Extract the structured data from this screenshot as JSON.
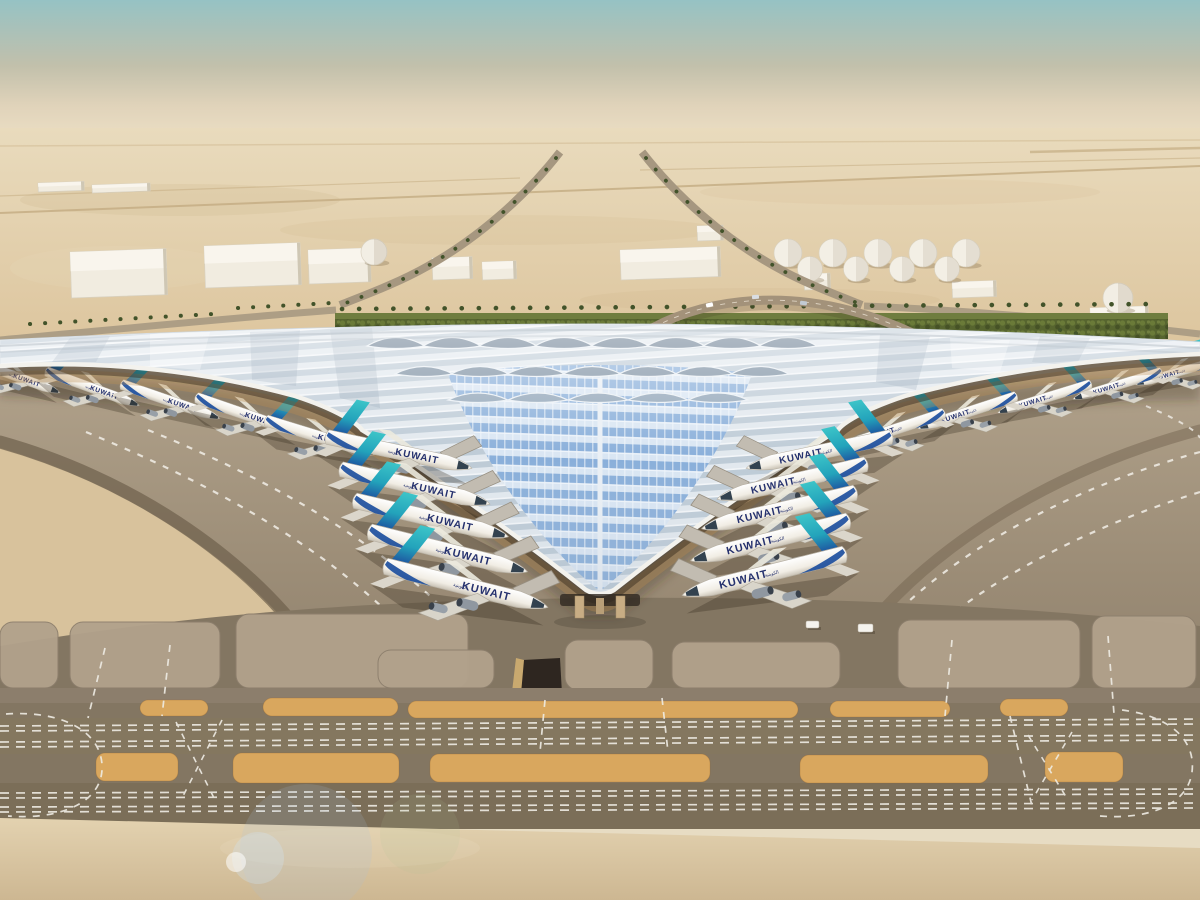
{
  "scene": {
    "name": "kuwait-airport-terminal-aerial-rendering",
    "subject": "Trefoil-roofed airport terminal in desert with aircraft at gates",
    "sky_top": "#9dc6c6",
    "sky_horizon": "#e9dcc2"
  },
  "airline": {
    "title": "KUWAIT",
    "arabic_script": "الكويتية",
    "tail_teal": "#35b9c2",
    "tail_blue": "#1d4f9e",
    "title_color": "#25316e"
  },
  "palette": {
    "desert": "#e2cfa9",
    "apron": "#ab9c85",
    "taxiway": "#84775f",
    "sand_island": "#d9a75e",
    "bottom_sand": "#ddcba7",
    "roof_light": "#e3e9ef",
    "roof_stripe": "#b9c7d3",
    "v_blue": "#84abd8",
    "hedge_green": "#57652f",
    "fascia_white": "#f3f2ed"
  },
  "aircraft": [
    {
      "x": 398,
      "y": 452,
      "r": 12,
      "s": 1.22,
      "flip": 0,
      "bridge": 1
    },
    {
      "x": 414,
      "y": 486,
      "r": 13,
      "s": 1.26,
      "flip": 0,
      "bridge": 1
    },
    {
      "x": 430,
      "y": 518,
      "r": 13,
      "s": 1.3,
      "flip": 0,
      "bridge": 1
    },
    {
      "x": 447,
      "y": 551,
      "r": 14,
      "s": 1.34,
      "flip": 0,
      "bridge": 1
    },
    {
      "x": 465,
      "y": 586,
      "r": 14,
      "s": 1.38,
      "flip": 0,
      "bridge": 1
    },
    {
      "x": 820,
      "y": 452,
      "r": 12,
      "s": 1.22,
      "flip": 1,
      "bridge": 1
    },
    {
      "x": 793,
      "y": 481,
      "r": 13,
      "s": 1.26,
      "flip": 1,
      "bridge": 1
    },
    {
      "x": 780,
      "y": 510,
      "r": 13,
      "s": 1.3,
      "flip": 1,
      "bridge": 1
    },
    {
      "x": 771,
      "y": 540,
      "r": 14,
      "s": 1.34,
      "flip": 1,
      "bridge": 1
    },
    {
      "x": 765,
      "y": 574,
      "r": 14,
      "s": 1.38,
      "flip": 1,
      "bridge": 1
    },
    {
      "x": 15,
      "y": 376,
      "r": 20,
      "s": 0.78,
      "flip": 0,
      "bridge": 0
    },
    {
      "x": 92,
      "y": 388,
      "r": 20,
      "s": 0.82,
      "flip": 0,
      "bridge": 0
    },
    {
      "x": 170,
      "y": 401,
      "r": 19,
      "s": 0.86,
      "flip": 0,
      "bridge": 0
    },
    {
      "x": 247,
      "y": 415,
      "r": 19,
      "s": 0.9,
      "flip": 0,
      "bridge": 0
    },
    {
      "x": 320,
      "y": 437,
      "r": 17,
      "s": 0.95,
      "flip": 0,
      "bridge": 0
    },
    {
      "x": 1178,
      "y": 372,
      "r": 16,
      "s": 0.72,
      "flip": 1,
      "bridge": 0
    },
    {
      "x": 1118,
      "y": 385,
      "r": 17,
      "s": 0.76,
      "flip": 1,
      "bridge": 0
    },
    {
      "x": 1045,
      "y": 398,
      "r": 17,
      "s": 0.8,
      "flip": 1,
      "bridge": 0
    },
    {
      "x": 968,
      "y": 412,
      "r": 18,
      "s": 0.85,
      "flip": 1,
      "bridge": 0
    },
    {
      "x": 893,
      "y": 430,
      "r": 18,
      "s": 0.9,
      "flip": 1,
      "bridge": 0
    }
  ],
  "roof_modules": {
    "rows": [
      {
        "y": 346,
        "rx": 29,
        "ry": 17,
        "fill": "#5e7389",
        "xs": [
          396,
          452,
          508,
          564,
          620,
          676,
          732,
          788
        ]
      },
      {
        "y": 374,
        "rx": 29,
        "ry": 15,
        "fill": "#74889c",
        "xs": [
          424,
          480,
          536,
          592,
          648,
          704,
          760
        ]
      },
      {
        "y": 400,
        "rx": 30,
        "ry": 14,
        "fill": "#8ba0b4",
        "xs": [
          478,
          538,
          598,
          658,
          718
        ]
      }
    ]
  },
  "fuel_tanks": {
    "rows": [
      {
        "y": 253,
        "r": 14,
        "xs": [
          788,
          833,
          878,
          923,
          966
        ]
      },
      {
        "y": 269,
        "r": 12.5,
        "xs": [
          810,
          856,
          902,
          947
        ]
      }
    ]
  },
  "buildings": [
    {
      "x": 70,
      "y": 252,
      "w": 96,
      "h": 46
    },
    {
      "x": 204,
      "y": 246,
      "w": 96,
      "h": 42
    },
    {
      "x": 308,
      "y": 250,
      "w": 62,
      "h": 34
    },
    {
      "x": 432,
      "y": 258,
      "w": 40,
      "h": 22
    },
    {
      "x": 482,
      "y": 262,
      "w": 34,
      "h": 18
    },
    {
      "x": 620,
      "y": 250,
      "w": 100,
      "h": 30
    },
    {
      "x": 697,
      "y": 226,
      "w": 26,
      "h": 15
    },
    {
      "x": 804,
      "y": 274,
      "w": 26,
      "h": 16
    },
    {
      "x": 952,
      "y": 282,
      "w": 44,
      "h": 16
    },
    {
      "x": 1090,
      "y": 308,
      "w": 58,
      "h": 14
    },
    {
      "x": 38,
      "y": 183,
      "w": 46,
      "h": 9
    },
    {
      "x": 92,
      "y": 185,
      "w": 58,
      "h": 8
    }
  ],
  "domes": [
    {
      "cx": 374,
      "cy": 252,
      "r": 13
    },
    {
      "cx": 1118,
      "cy": 298,
      "r": 15
    }
  ],
  "sand_islands": [
    {
      "x": 140,
      "y": 700,
      "w": 68,
      "h": 16
    },
    {
      "x": 263,
      "y": 698,
      "w": 135,
      "h": 18
    },
    {
      "x": 408,
      "y": 701,
      "w": 390,
      "h": 17
    },
    {
      "x": 830,
      "y": 701,
      "w": 120,
      "h": 16
    },
    {
      "x": 1000,
      "y": 699,
      "w": 68,
      "h": 17
    },
    {
      "x": 96,
      "y": 753,
      "w": 82,
      "h": 28
    },
    {
      "x": 233,
      "y": 753,
      "w": 166,
      "h": 30
    },
    {
      "x": 430,
      "y": 754,
      "w": 280,
      "h": 28
    },
    {
      "x": 800,
      "y": 755,
      "w": 188,
      "h": 28
    },
    {
      "x": 1045,
      "y": 752,
      "w": 78,
      "h": 30
    }
  ],
  "stand_slabs": [
    {
      "x": 0,
      "y": 622,
      "w": 58,
      "h": 66
    },
    {
      "x": 70,
      "y": 622,
      "w": 150,
      "h": 66
    },
    {
      "x": 236,
      "y": 614,
      "w": 232,
      "h": 74
    },
    {
      "x": 378,
      "y": 650,
      "w": 116,
      "h": 38
    },
    {
      "x": 565,
      "y": 640,
      "w": 88,
      "h": 50
    },
    {
      "x": 672,
      "y": 642,
      "w": 168,
      "h": 46
    },
    {
      "x": 898,
      "y": 620,
      "w": 182,
      "h": 68
    },
    {
      "x": 1092,
      "y": 616,
      "w": 104,
      "h": 72
    }
  ],
  "vehicles": [
    {
      "x": 806,
      "y": 621,
      "w": 13,
      "h": 7
    },
    {
      "x": 858,
      "y": 624,
      "w": 15,
      "h": 8
    }
  ]
}
